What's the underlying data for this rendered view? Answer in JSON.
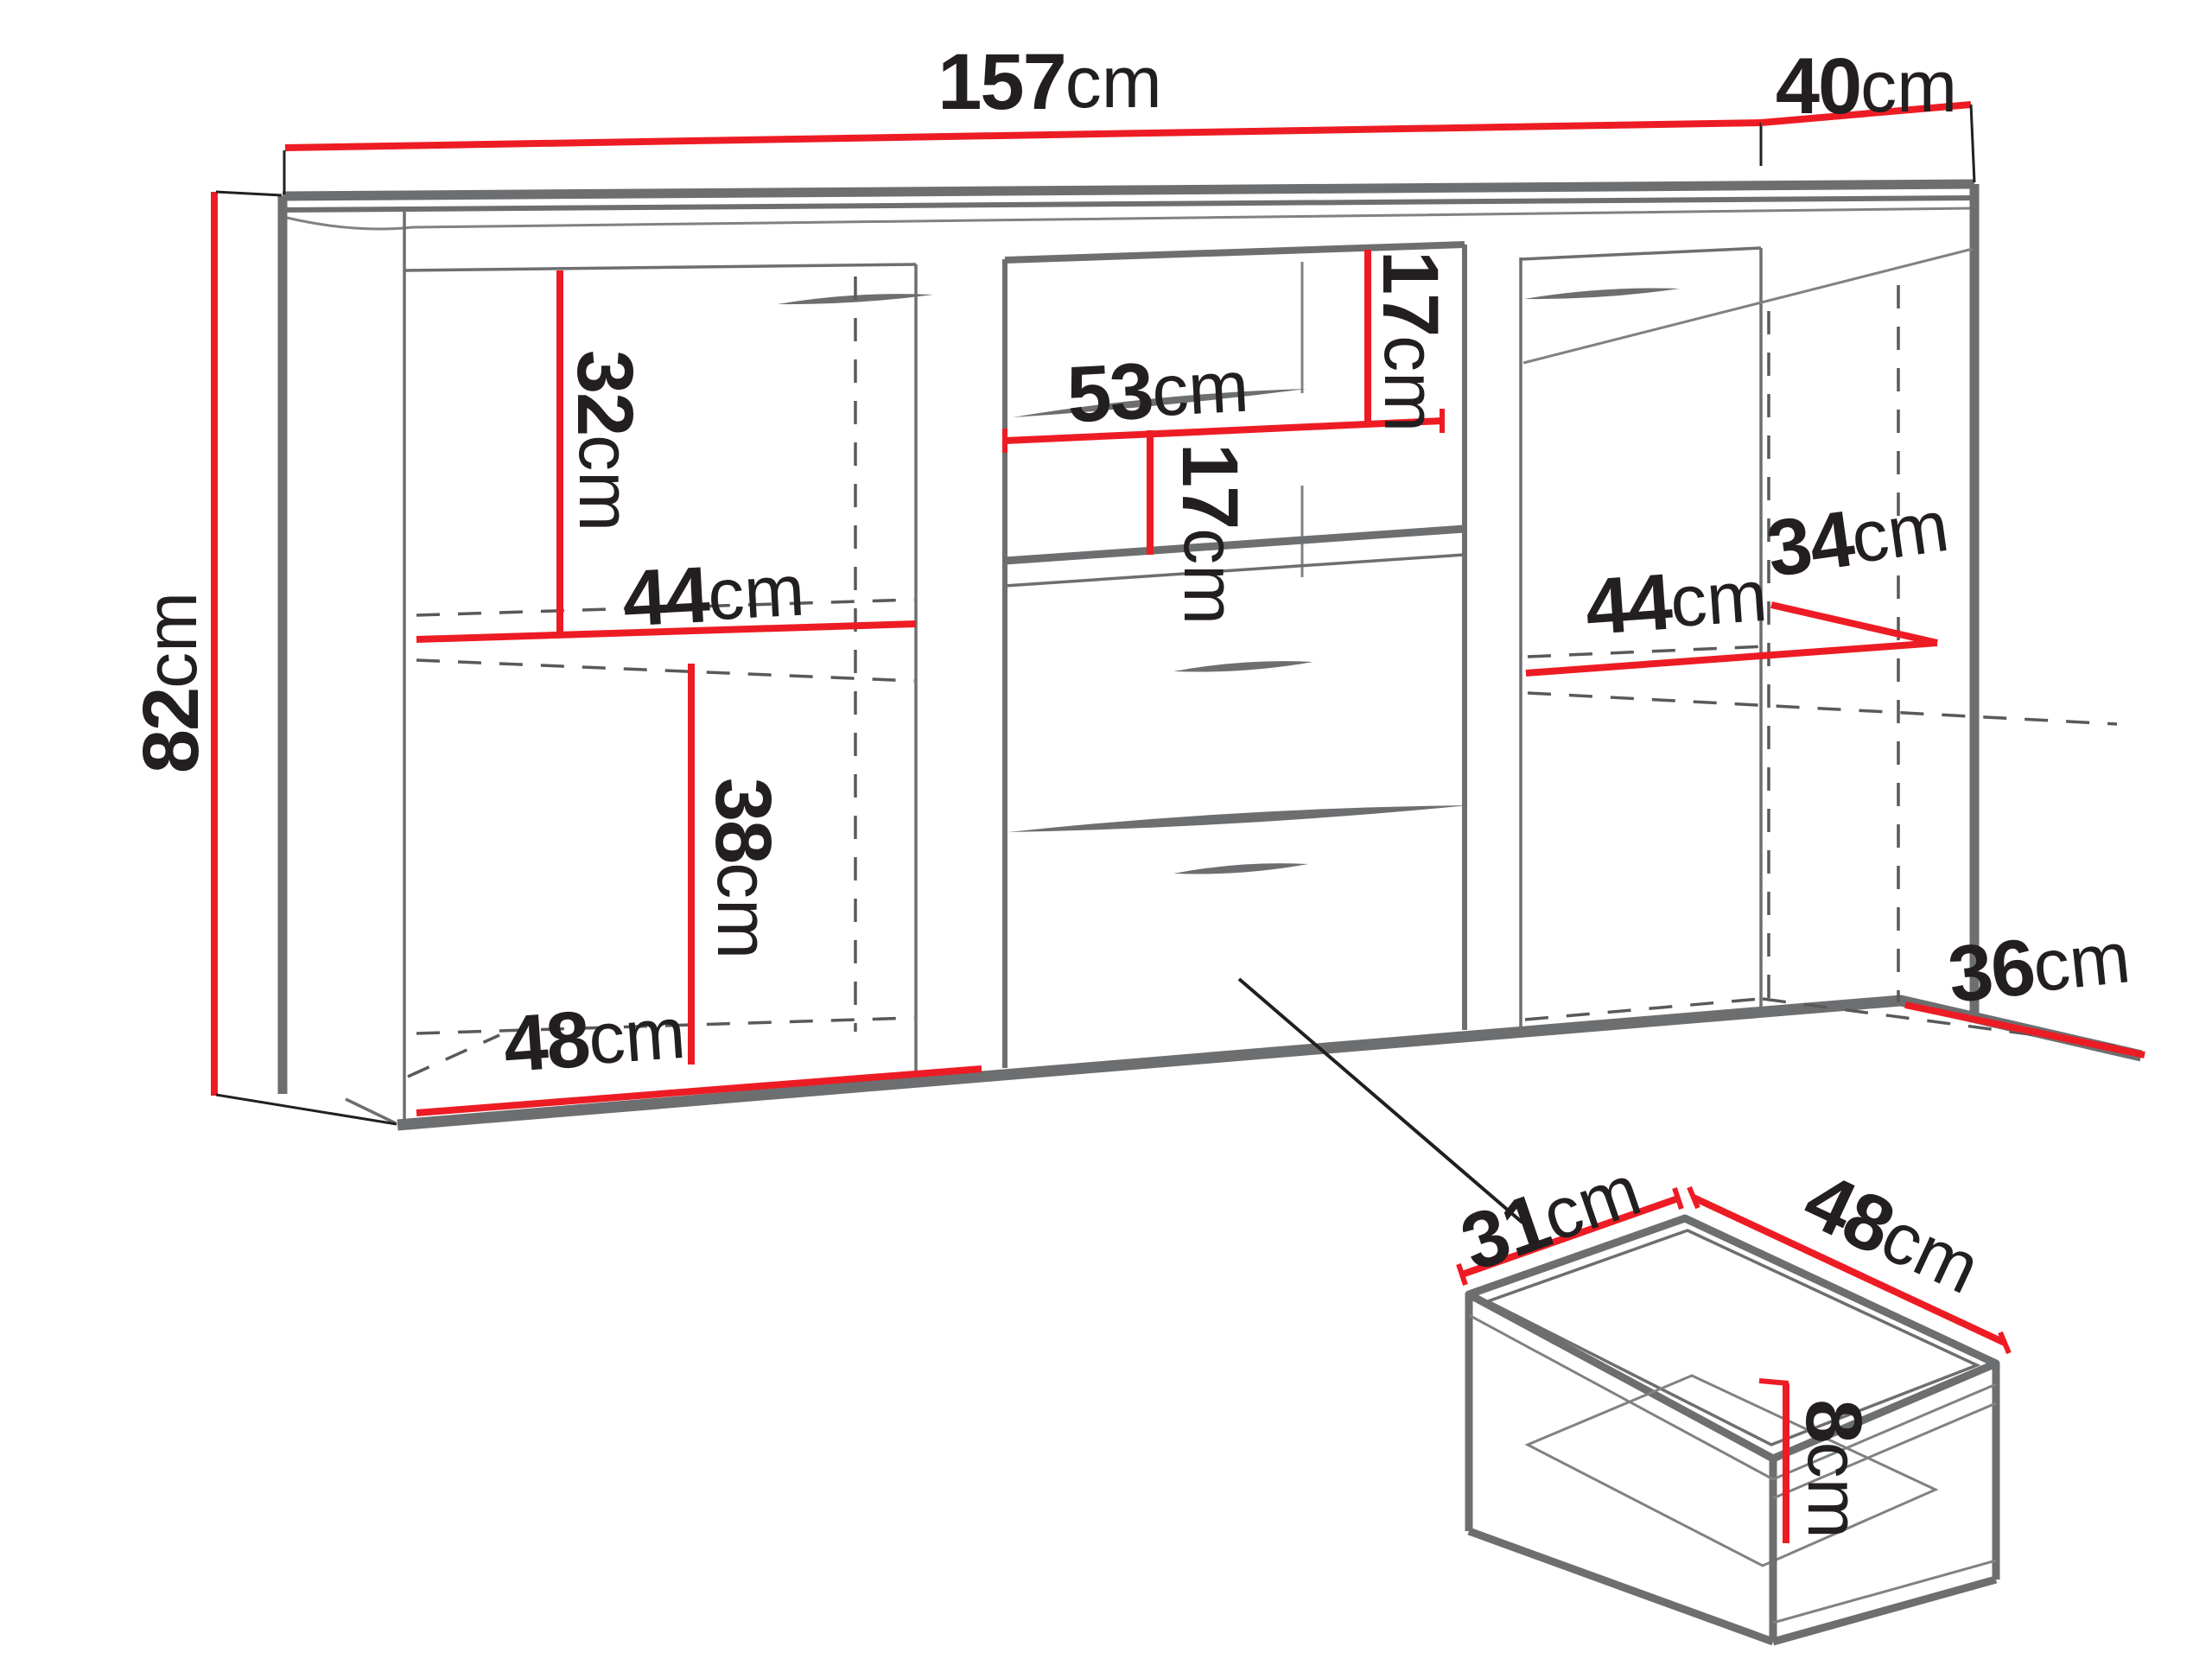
{
  "diagram": {
    "colors": {
      "dimension_accent": "#ED1C24",
      "outline_gray": "#6D6E70",
      "label_text": "#231F20",
      "background": "#FFFFFF"
    },
    "cabinet": {
      "overall_width": {
        "value": "157",
        "unit": "cm"
      },
      "overall_depth": {
        "value": "40",
        "unit": "cm"
      },
      "overall_height": {
        "value": "82",
        "unit": "cm"
      },
      "left_section": {
        "upper_compartment_height": {
          "value": "32",
          "unit": "cm"
        },
        "shelf_width": {
          "value": "44",
          "unit": "cm"
        },
        "lower_compartment_height": {
          "value": "38",
          "unit": "cm"
        },
        "bottom_interior_width": {
          "value": "48",
          "unit": "cm"
        }
      },
      "center_section": {
        "shelf_width": {
          "value": "53",
          "unit": "cm"
        },
        "upper_gap_height": {
          "value": "17",
          "unit": "cm"
        },
        "lower_gap_height": {
          "value": "17",
          "unit": "cm"
        }
      },
      "right_section": {
        "interior_width": {
          "value": "44",
          "unit": "cm"
        },
        "interior_depth_mid": {
          "value": "34",
          "unit": "cm"
        },
        "interior_depth_bottom": {
          "value": "36",
          "unit": "cm"
        }
      }
    },
    "drawer_detail": {
      "inner_depth": {
        "value": "31",
        "unit": "cm"
      },
      "inner_width": {
        "value": "48",
        "unit": "cm"
      },
      "inner_height": {
        "value": "8",
        "unit": "cm"
      }
    }
  }
}
